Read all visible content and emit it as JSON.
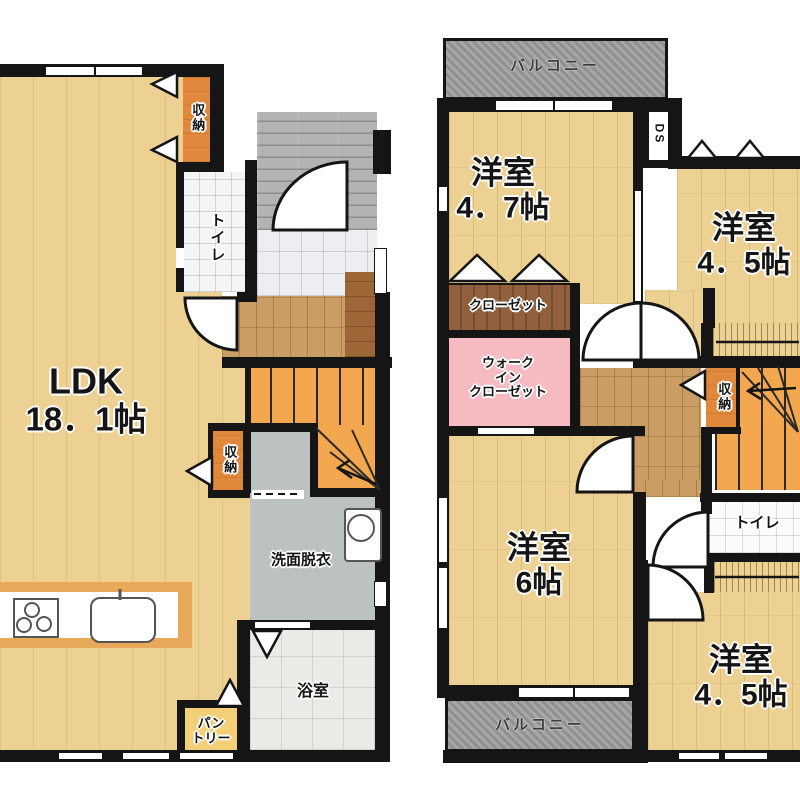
{
  "colors": {
    "wall": "#151515",
    "floor_tan": "#ecd193",
    "hall_wood": "#c99d63",
    "step_brown": "#9c6636",
    "porch_gray": "#b3b3b3",
    "balcony_gray": "#9e9e9e",
    "genkan_tile": "#edeef2",
    "bath_gray": "#eaeae6",
    "washroom_gray": "#bcc1c1",
    "stairs_orange": "#f3a74f",
    "storage_orange": "#e0893c",
    "pantry_yellow": "#f3d077",
    "closet_brown": "#92603c",
    "wic_pink": "#f6bac2",
    "counter_orange": "#e9a95b"
  },
  "floor1": {
    "ldk": {
      "label": "LDK",
      "size": "18．1帖"
    },
    "storage_top": {
      "label": "収納"
    },
    "toilet": {
      "label": "トイレ"
    },
    "storage_mid": {
      "label": "収納"
    },
    "washroom": {
      "label": "洗面脱衣"
    },
    "bathroom": {
      "label": "浴室"
    },
    "pantry": {
      "lines": [
        "パン",
        "トリー"
      ]
    }
  },
  "floor2": {
    "balcony_top": {
      "label": "バルコニー"
    },
    "duct_space": {
      "label": "DS"
    },
    "room_47": {
      "label": "洋室",
      "size": "4．7帖"
    },
    "room_45_top": {
      "label": "洋室",
      "size": "4．5帖"
    },
    "closet": {
      "label": "クローゼット"
    },
    "walk_in_closet": {
      "lines": [
        "ウォーク",
        "イン",
        "クローゼット"
      ]
    },
    "storage": {
      "label": "収納"
    },
    "toilet": {
      "label": "トイレ"
    },
    "room_6": {
      "label": "洋室",
      "size": "6帖"
    },
    "room_45_bottom": {
      "label": "洋室",
      "size": "4．5帖"
    },
    "balcony_bottom": {
      "label": "バルコニー"
    }
  }
}
